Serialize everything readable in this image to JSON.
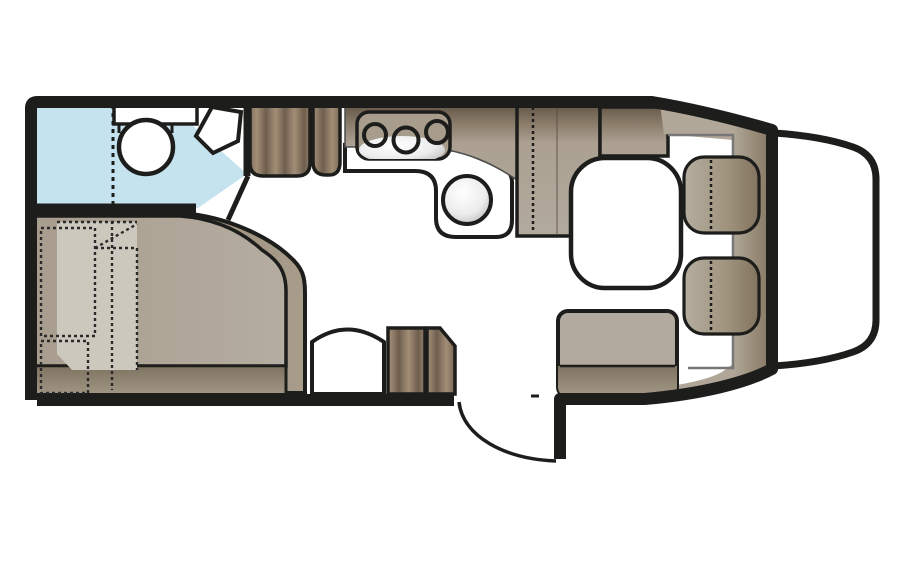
{
  "diagram": {
    "type": "caravan-floorplan",
    "description": "Top-down floor plan of a motorhome / caravan interior"
  },
  "colors": {
    "wall": "#1d1d1b",
    "floor": "#ffffff",
    "bathroom_blue": "#c5e3ee",
    "furniture_taupe": "#b2aa9e",
    "furniture_dark": "#8a7b68",
    "wood_light": "#9a8772",
    "wood_dark": "#6a594a",
    "panel_light": "#cdc8be",
    "metal_light": "#ffffff",
    "metal_dark": "#b9b9b9",
    "line_grey": "#777777"
  },
  "legend": {
    "bathroom": "washroom with shower, toilet and corner basin",
    "shower": "shower cubicle",
    "toilet": "toilet",
    "basin": "corner basin",
    "bed": "french bed with under-bed storage",
    "wardrobe": "wardrobe cabinets",
    "kitchen": "kitchen worktop with 3-burner hob and round sink",
    "fridge": "tall fridge / cabinet unit",
    "sideboard": "low sideboard",
    "table": "dinette table",
    "bench": "dinette side bench",
    "seat_front": "swivelled cab seat (driver side)",
    "seat_rear": "swivelled cab seat (passenger side)",
    "entry_door": "entrance door with swing arc",
    "cab": "vehicle cab front"
  }
}
